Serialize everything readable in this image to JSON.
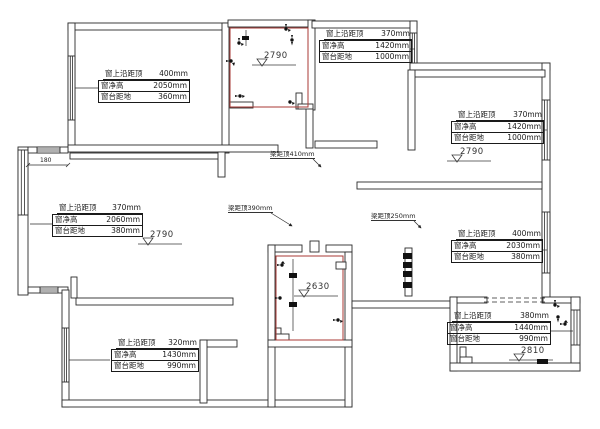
{
  "labels": {
    "window_top": "窗上沿距顶",
    "window_height": "窗净高",
    "window_sill": "窗台距地"
  },
  "annotations": [
    {
      "position": "top-left",
      "top": "400mm",
      "height": "2050mm",
      "sill": "360mm"
    },
    {
      "position": "top-middle",
      "top": "370mm",
      "height": "1420mm",
      "sill": "1000mm"
    },
    {
      "position": "right-top",
      "top": "370mm",
      "height": "1420mm",
      "sill": "1000mm"
    },
    {
      "position": "left-middle",
      "top": "370mm",
      "height": "2060mm",
      "sill": "380mm"
    },
    {
      "position": "right-middle",
      "top": "400mm",
      "height": "2030mm",
      "sill": "380mm"
    },
    {
      "position": "bottom-left",
      "top": "320mm",
      "height": "1430mm",
      "sill": "990mm"
    },
    {
      "position": "bottom-right",
      "top": "380mm",
      "height": "1440mm",
      "sill": "990mm"
    }
  ],
  "beams": [
    {
      "text": "梁距顶410mm"
    },
    {
      "text": "梁距顶390mm"
    },
    {
      "text": "梁距顶250mm"
    }
  ],
  "levels": [
    {
      "value": "2790"
    },
    {
      "value": "2790"
    },
    {
      "value": "2790"
    },
    {
      "value": "2630"
    },
    {
      "value": "2810"
    }
  ],
  "dimensions": [
    {
      "value": "180"
    }
  ],
  "colors": {
    "wall": "#2b2b2b",
    "red_room": "#a83a35",
    "text": "#1a1a1a"
  }
}
